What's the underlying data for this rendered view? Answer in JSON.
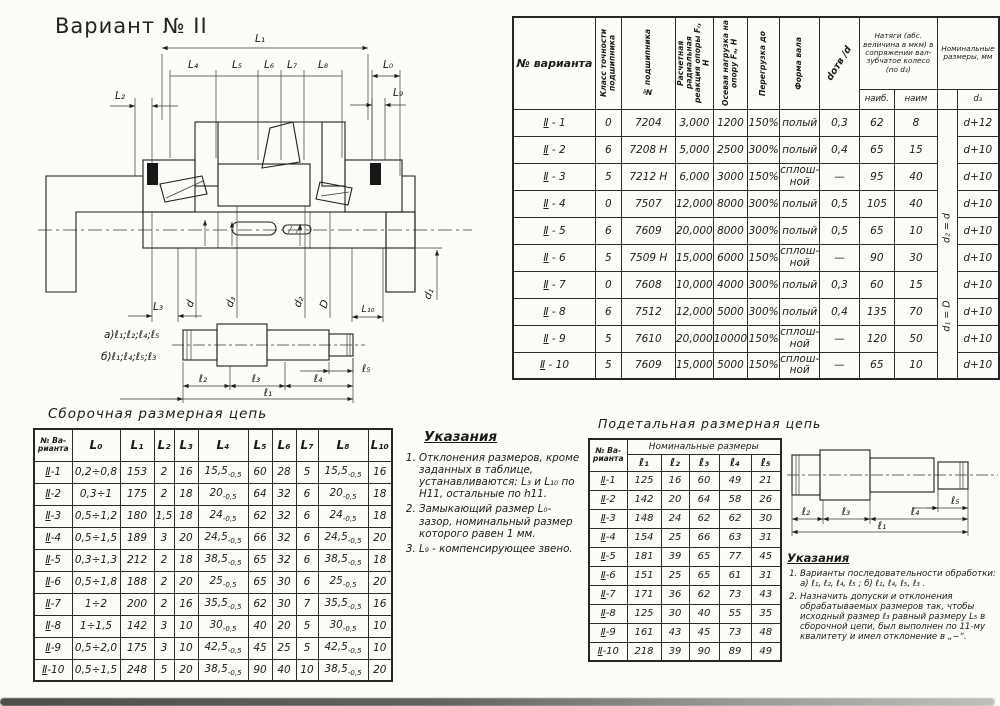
{
  "page": {
    "title": "Вариант № II"
  },
  "bearing_table": {
    "headers": {
      "variant": "№ варианта",
      "accuracy": "Класс точности подшипника",
      "bearing_no": "№ подшипника",
      "radial": "Расчетная радиальная реакция опоры Fᵣ, Н",
      "axial": "Осевая нагрузка на опору Fₐ, Н",
      "overload": "Перегрузка до",
      "shaft_form": "Форма вала",
      "dotv": "dотв /d",
      "natyag_group": "Натяги (абс. величина в мкм) в сопряжении вал-зубчатое колесо (по d₃)",
      "natyag_max": "наиб.",
      "natyag_min": "наим",
      "nominal_group": "Номинальные размеры, мм",
      "nominal_d3": "d₃"
    },
    "merged_note_top": "d₂ = d",
    "merged_note_bottom": "d₁ = D",
    "rows": [
      [
        "Ⅱ - 1",
        "0",
        "7204",
        "3,000",
        "1200",
        "150%",
        "полый",
        "0,3",
        "62",
        "8",
        "d+12"
      ],
      [
        "Ⅱ - 2",
        "6",
        "7208 Н",
        "5,000",
        "2500",
        "300%",
        "полый",
        "0,4",
        "65",
        "15",
        "d+10"
      ],
      [
        "Ⅱ - 3",
        "5",
        "7212 Н",
        "6,000",
        "3000",
        "150%",
        "сплош-ной",
        "—",
        "95",
        "40",
        "d+10"
      ],
      [
        "Ⅱ - 4",
        "0",
        "7507",
        "12,000",
        "8000",
        "300%",
        "полый",
        "0,5",
        "105",
        "40",
        "d+10"
      ],
      [
        "Ⅱ - 5",
        "6",
        "7609",
        "20,000",
        "8000",
        "300%",
        "полый",
        "0,5",
        "65",
        "10",
        "d+10"
      ],
      [
        "Ⅱ - 6",
        "5",
        "7509 Н",
        "15,000",
        "6000",
        "150%",
        "сплош-ной",
        "—",
        "90",
        "30",
        "d+10"
      ],
      [
        "Ⅱ - 7",
        "0",
        "7608",
        "10,000",
        "4000",
        "300%",
        "полый",
        "0,3",
        "60",
        "15",
        "d+10"
      ],
      [
        "Ⅱ - 8",
        "6",
        "7512",
        "12,000",
        "5000",
        "300%",
        "полый",
        "0,4",
        "135",
        "70",
        "d+10"
      ],
      [
        "Ⅱ - 9",
        "5",
        "7610",
        "20,000",
        "10000",
        "150%",
        "сплош-ной",
        "—",
        "120",
        "50",
        "d+10"
      ],
      [
        "Ⅱ - 10",
        "5",
        "7609",
        "15,000",
        "5000",
        "150%",
        "сплош-ной",
        "—",
        "65",
        "10",
        "d+10"
      ]
    ]
  },
  "assembly_chain": {
    "title": "Сборочная размерная цепь",
    "headers": [
      "№ Ва- рианта",
      "L₀",
      "L₁",
      "L₂",
      "L₃",
      "L₄",
      "L₅",
      "L₆",
      "L₇",
      "L₈",
      "L₁₀"
    ],
    "rows": [
      [
        "Ⅱ-1",
        "0,2÷0,8",
        "153",
        "2",
        "16",
        "15,5~-0,5",
        "60",
        "28",
        "5",
        "15,5~-0,5",
        "16"
      ],
      [
        "Ⅱ-2",
        "0,3÷1",
        "175",
        "2",
        "18",
        "20~-0,5",
        "64",
        "32",
        "6",
        "20~-0,5",
        "18"
      ],
      [
        "Ⅱ-3",
        "0,5÷1,2",
        "180",
        "1,5",
        "18",
        "24~-0,5",
        "62",
        "32",
        "6",
        "24~-0,5",
        "18"
      ],
      [
        "Ⅱ-4",
        "0,5÷1,5",
        "189",
        "3",
        "20",
        "24,5~-0,5",
        "66",
        "32",
        "6",
        "24,5~-0,5",
        "20"
      ],
      [
        "Ⅱ-5",
        "0,3÷1,3",
        "212",
        "2",
        "18",
        "38,5~-0,5",
        "65",
        "32",
        "6",
        "38,5~-0,5",
        "18"
      ],
      [
        "Ⅱ-6",
        "0,5÷1,8",
        "188",
        "2",
        "20",
        "25~-0,5",
        "65",
        "30",
        "6",
        "25~-0,5",
        "20"
      ],
      [
        "Ⅱ-7",
        "1÷2",
        "200",
        "2",
        "16",
        "35,5~-0,5",
        "62",
        "30",
        "7",
        "35,5~-0,5",
        "16"
      ],
      [
        "Ⅱ-8",
        "1÷1,5",
        "142",
        "3",
        "10",
        "30~-0,5",
        "40",
        "20",
        "5",
        "30~-0,5",
        "10"
      ],
      [
        "Ⅱ-9",
        "0,5÷2,0",
        "175",
        "3",
        "10",
        "42,5~-0,5",
        "45",
        "25",
        "5",
        "42,5~-0,5",
        "10"
      ],
      [
        "Ⅱ-10",
        "0,5÷1,5",
        "248",
        "5",
        "20",
        "38,5~-0,5",
        "90",
        "40",
        "10",
        "38,5~-0,5",
        "20"
      ]
    ]
  },
  "main_instructions": {
    "title": "Указания",
    "items": [
      "Отклонения размеров, кроме заданных в таблице, устанавливаются: L₃ и L₁₀ по H11, остальные по h11.",
      "Замыкающий размер L₀-зазор, номинальный размер которого равен 1 мм.",
      "L₉ - компенсирующее звено."
    ]
  },
  "detail_chain": {
    "title": "Подетальная размерная цепь",
    "header_variant": "№ Ва- рианта",
    "header_group": "Номинальные размеры",
    "columns": [
      "ℓ₁",
      "ℓ₂",
      "ℓ₃",
      "ℓ₄",
      "ℓ₅"
    ],
    "rows": [
      [
        "Ⅱ-1",
        "125",
        "16",
        "60",
        "49",
        "21"
      ],
      [
        "Ⅱ-2",
        "142",
        "20",
        "64",
        "58",
        "26"
      ],
      [
        "Ⅱ-3",
        "148",
        "24",
        "62",
        "62",
        "30"
      ],
      [
        "Ⅱ-4",
        "154",
        "25",
        "66",
        "63",
        "31"
      ],
      [
        "Ⅱ-5",
        "181",
        "39",
        "65",
        "77",
        "45"
      ],
      [
        "Ⅱ-6",
        "151",
        "25",
        "65",
        "61",
        "31"
      ],
      [
        "Ⅱ-7",
        "171",
        "36",
        "62",
        "73",
        "43"
      ],
      [
        "Ⅱ-8",
        "125",
        "30",
        "40",
        "55",
        "35"
      ],
      [
        "Ⅱ-9",
        "161",
        "43",
        "45",
        "73",
        "48"
      ],
      [
        "Ⅱ-10",
        "218",
        "39",
        "90",
        "89",
        "49"
      ]
    ]
  },
  "detail_instructions": {
    "title": "Указания",
    "items": [
      "Варианты последовательности обработки:  а) ℓ₁, ℓ₂, ℓ₄, ℓ₅ ;   б) ℓ₁, ℓ₄, ℓ₅, ℓ₃ .",
      "Назначить допуски и отклонения обрабатываемых размеров так, чтобы исходный размер ℓ₃ равный размеру L₅ в сборочной цепи, был выполнен по 11-му квалитету и имел отклонение в „−“."
    ]
  },
  "main_drawing": {
    "dim_l1": "L₁",
    "dim_l4": "L₄",
    "dim_l5": "L₅",
    "dim_l6": "L₆",
    "dim_l7": "L₇",
    "dim_l8": "L₈",
    "dim_l0": "L₀",
    "dim_l2": "L₂",
    "dim_l9": "L₉",
    "dim_l3": "L₃",
    "dim_l10": "L₁₀",
    "dia_d": "d",
    "dia_d3": "d₃",
    "dia_d2": "d₂",
    "dia_D": "D",
    "dia_d1": "d₁",
    "variant_a": "а)ℓ₁;ℓ₂;ℓ₄;ℓ₅",
    "variant_b": "б)ℓ₁;ℓ₄;ℓ₅;ℓ₃",
    "low_l2": "ℓ₂",
    "low_l3": "ℓ₃",
    "low_l4": "ℓ₄",
    "low_l5": "ℓ₅",
    "low_l1": "ℓ₁"
  },
  "detail_drawing": {
    "l2": "ℓ₂",
    "l3": "ℓ₃",
    "l4": "ℓ₄",
    "l5": "ℓ₅",
    "l1": "ℓ₁"
  }
}
